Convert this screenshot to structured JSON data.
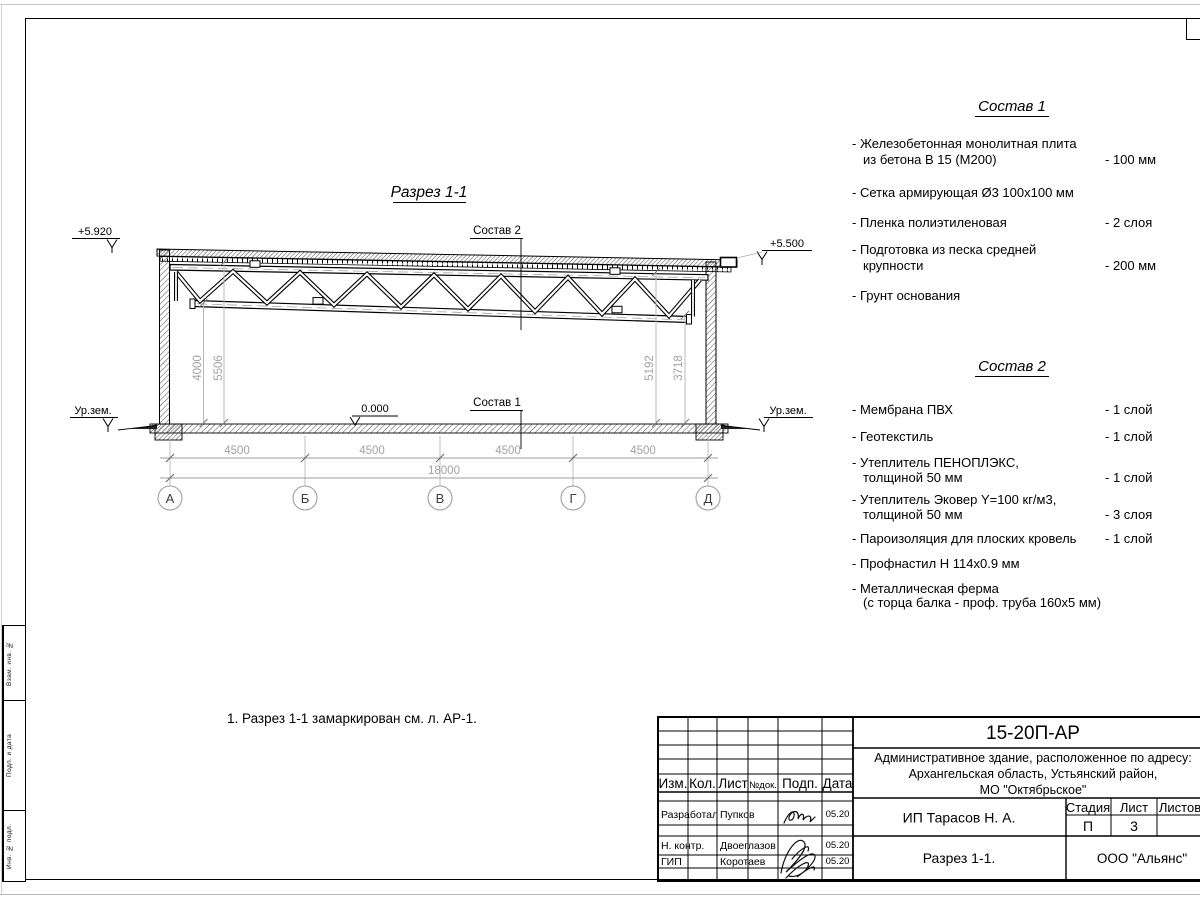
{
  "drawing": {
    "title": "Разрез 1-1",
    "elev_left": "+5.920",
    "elev_right": "+5.500",
    "ground_left": "Ур.зем.",
    "ground_right": "Ур.зем.",
    "zero_mark": "0.000",
    "comp2_label": "Состав 2",
    "comp1_label": "Состав 1",
    "dims_h": [
      "4500",
      "4500",
      "4500",
      "4500"
    ],
    "dim_total": "18000",
    "dims_v": [
      "4000",
      "5506",
      "5192",
      "3718"
    ],
    "axes": [
      "А",
      "Б",
      "В",
      "Г",
      "Д"
    ]
  },
  "comp1": {
    "title": "Состав 1",
    "lines": [
      {
        "t": "- Железобетонная  монолитная плита",
        "v": ""
      },
      {
        "t": "из бетона В 15 (М200)",
        "v": "- 100 мм"
      },
      {
        "t": "- Сетка армирующая Ø3 100х100 мм",
        "v": ""
      },
      {
        "t": "- Пленка полиэтиленовая",
        "v": "-  2 слоя"
      },
      {
        "t": "- Подготовка из песка средней",
        "v": ""
      },
      {
        "t": "крупности",
        "v": "- 200 мм"
      },
      {
        "t": "- Грунт основания",
        "v": ""
      }
    ]
  },
  "comp2": {
    "title": "Состав 2",
    "lines": [
      {
        "t": "- Мембрана ПВХ",
        "v": "- 1 слой"
      },
      {
        "t": "- Геотекстиль",
        "v": "- 1 слой"
      },
      {
        "t": "- Утеплитель ПЕНОПЛЭКС,",
        "v": ""
      },
      {
        "t": "толщиной 50 мм",
        "v": "- 1 слой"
      },
      {
        "t": "- Утеплитель Эковер Y=100 кг/м3,",
        "v": ""
      },
      {
        "t": "толщиной 50 мм",
        "v": "- 3 слоя"
      },
      {
        "t": "- Пароизоляция для плоских кровель",
        "v": "- 1 слой"
      },
      {
        "t": "- Профнастил Н 114х0.9 мм",
        "v": ""
      },
      {
        "t": "- Металлическая ферма",
        "v": ""
      },
      {
        "t": "(с торца балка - проф. труба 160х5 мм)",
        "v": ""
      }
    ]
  },
  "note": "1. Разрез 1-1 замаркирован см. л. АР-1.",
  "titleblock": {
    "doc_code": "15-20П-АР",
    "address_lines": [
      "Административное здание, расположенное по адресу:",
      "Архангельская область, Устьянский район,",
      "МО \"Октябрьское\""
    ],
    "header_cols": [
      "Изм.",
      "Кол.",
      "Лист",
      "№док.",
      "Подп.",
      "Дата"
    ],
    "rows": [
      {
        "role": "Разработал",
        "name": "Пупков",
        "date": "05.20"
      },
      {
        "role": "Н. контр.",
        "name": "Двоеглазов",
        "date": "05.20"
      },
      {
        "role": "ГИП",
        "name": "Коротаев",
        "date": "05.20"
      }
    ],
    "client": "ИП Тарасов Н. А.",
    "stage_label": "Стадия",
    "sheet_label": "Лист",
    "sheets_label": "Листов",
    "stage": "П",
    "sheet": "3",
    "drawing_name": "Разрез 1-1.",
    "company": "ООО \"Альянс\""
  },
  "frame": {
    "side_labels": [
      "Взам. инв. №",
      "Подп. и дата",
      "Инв. № подл."
    ]
  },
  "colors": {
    "line": "#1a1a1a",
    "dim": "#a2a2a2",
    "paper": "#ffffff"
  }
}
